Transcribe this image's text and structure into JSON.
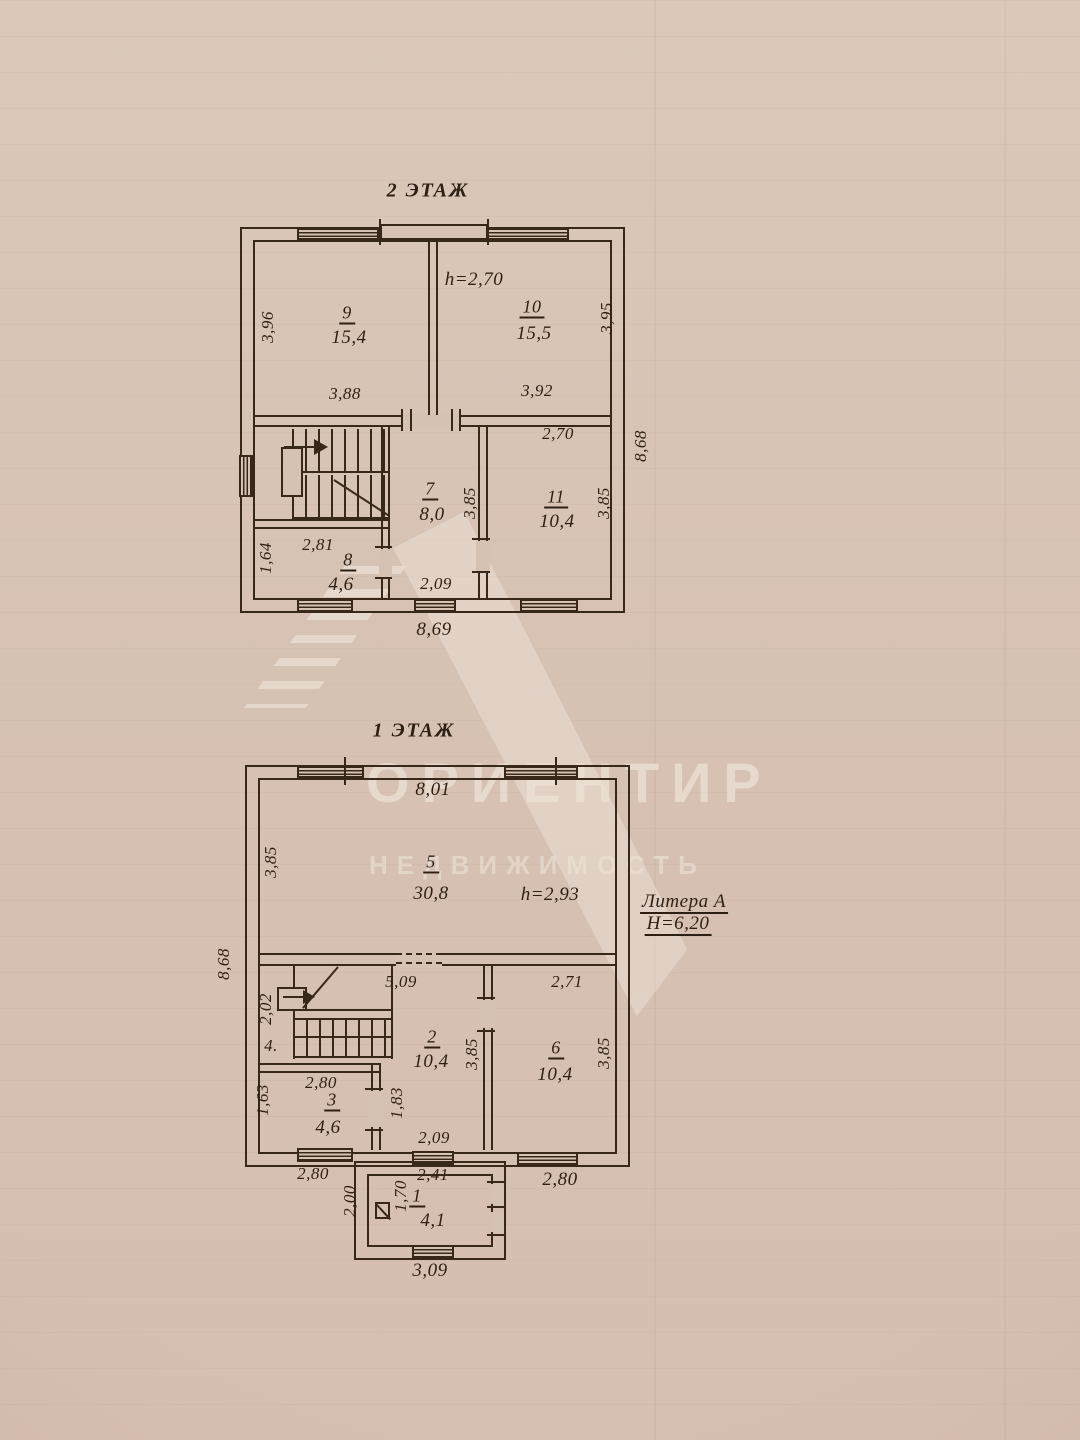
{
  "watermark": {
    "brand": "ОРИЕНТИР",
    "subtitle": "НЕДВИЖИМОСТЬ"
  },
  "floor2": {
    "title": "2 ЭТАЖ",
    "labels": {
      "h": "h=2,70",
      "room9_no": "9",
      "room9_area": "15,4",
      "room10_no": "10",
      "room10_area": "15,5",
      "room7_no": "7",
      "room7_area": "8,0",
      "room11_no": "11",
      "room11_area": "10,4",
      "room8_no": "8",
      "room8_area": "4,6",
      "dim_left": "3,96",
      "dim_right": "3,95",
      "dim_w9": "3,88",
      "dim_w10": "3,92",
      "dim_r11_w": "2,70",
      "dim_r7_d": "3,85",
      "dim_r11_d": "3,85",
      "dim_r8_w": "2,81",
      "dim_r8_d": "1,64",
      "dim_r7_w": "2,09",
      "dim_outer_right": "8,68",
      "dim_outer_bottom": "8,69"
    }
  },
  "floor1": {
    "title": "1 ЭТАЖ",
    "labels": {
      "h": "h=2,93",
      "litera": "Литера А",
      "height_total": "Н=6,20",
      "room5_no": "5",
      "room5_area": "30,8",
      "room2_no": "2",
      "room2_area": "10,4",
      "room6_no": "6",
      "room6_area": "10,4",
      "room3_no": "3",
      "room3_area": "4,6",
      "room4_no": "4.",
      "room1_no": "1",
      "room1_area": "4,1",
      "dim_top": "8,01",
      "dim_outer_left": "8,68",
      "dim_left5": "3,85",
      "dim_opening": "5,09",
      "dim_r6_w": "2,71",
      "dim_stair": "2,02",
      "dim_r2_d": "3,85",
      "dim_r6_d": "3,85",
      "dim_r3_w": "2,80",
      "dim_r3_d": "1,63",
      "dim_door": "1,83",
      "dim_r2_w": "2,09",
      "dim_bottom_left": "2,80",
      "dim_bottom_right": "2,80",
      "dim_porch_w": "2,41",
      "dim_porch_d": "1,70",
      "dim_porch_outer_d": "2,00",
      "dim_porch_bottom": "3,09"
    }
  }
}
